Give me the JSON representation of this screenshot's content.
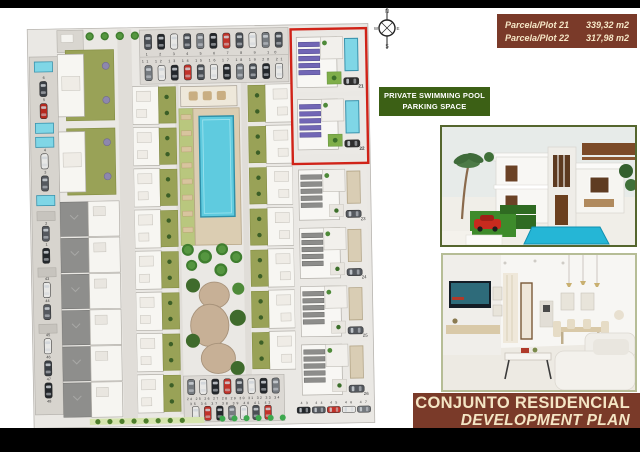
{
  "legend": {
    "rows": [
      {
        "label": "Parcela/Plot 21",
        "area": "339,32  m2"
      },
      {
        "label": "Parcela/Plot 22",
        "area": "317,98  m2"
      }
    ]
  },
  "pool_label": {
    "line1": "PRIVATE SWIMMING POOL",
    "line2": "PARKING SPACE"
  },
  "banner": {
    "line1": "CONJUNTO RESIDENCIAL",
    "line2": "DEVELOPMENT PLAN"
  },
  "compass": {
    "north": "N",
    "south": "S",
    "east": "E",
    "west": "W"
  },
  "siteplan": {
    "plots": {
      "p21": "21",
      "p22": "22",
      "p23": "23",
      "p24": "24",
      "p25": "25",
      "p26": "26"
    },
    "left_numbers": [
      "6",
      "5",
      "4",
      "3",
      "2",
      "1",
      "43",
      "44",
      "45",
      "46",
      "47",
      "48"
    ],
    "top_parking_row1": "1 2 3 4 5 6 7 8 9 10",
    "top_parking_row2": "11 12 13 14 15 16 17 18 19 20 21",
    "bottom_parking_row1": "24 25 26 27 28 29 30 31 32 33 34",
    "bottom_parking_row2": "35 36 37 38 39 40 41 42",
    "bottom_right_cars": "43 44 45 46 47"
  },
  "colors": {
    "banner_brown": "#7a3a29",
    "label_green": "#3c6015",
    "highlight_red": "#d02318",
    "pool_cyan": "#7fd6e6",
    "garden_olive": "#99a257",
    "cream_text": "#f4e5c4"
  }
}
